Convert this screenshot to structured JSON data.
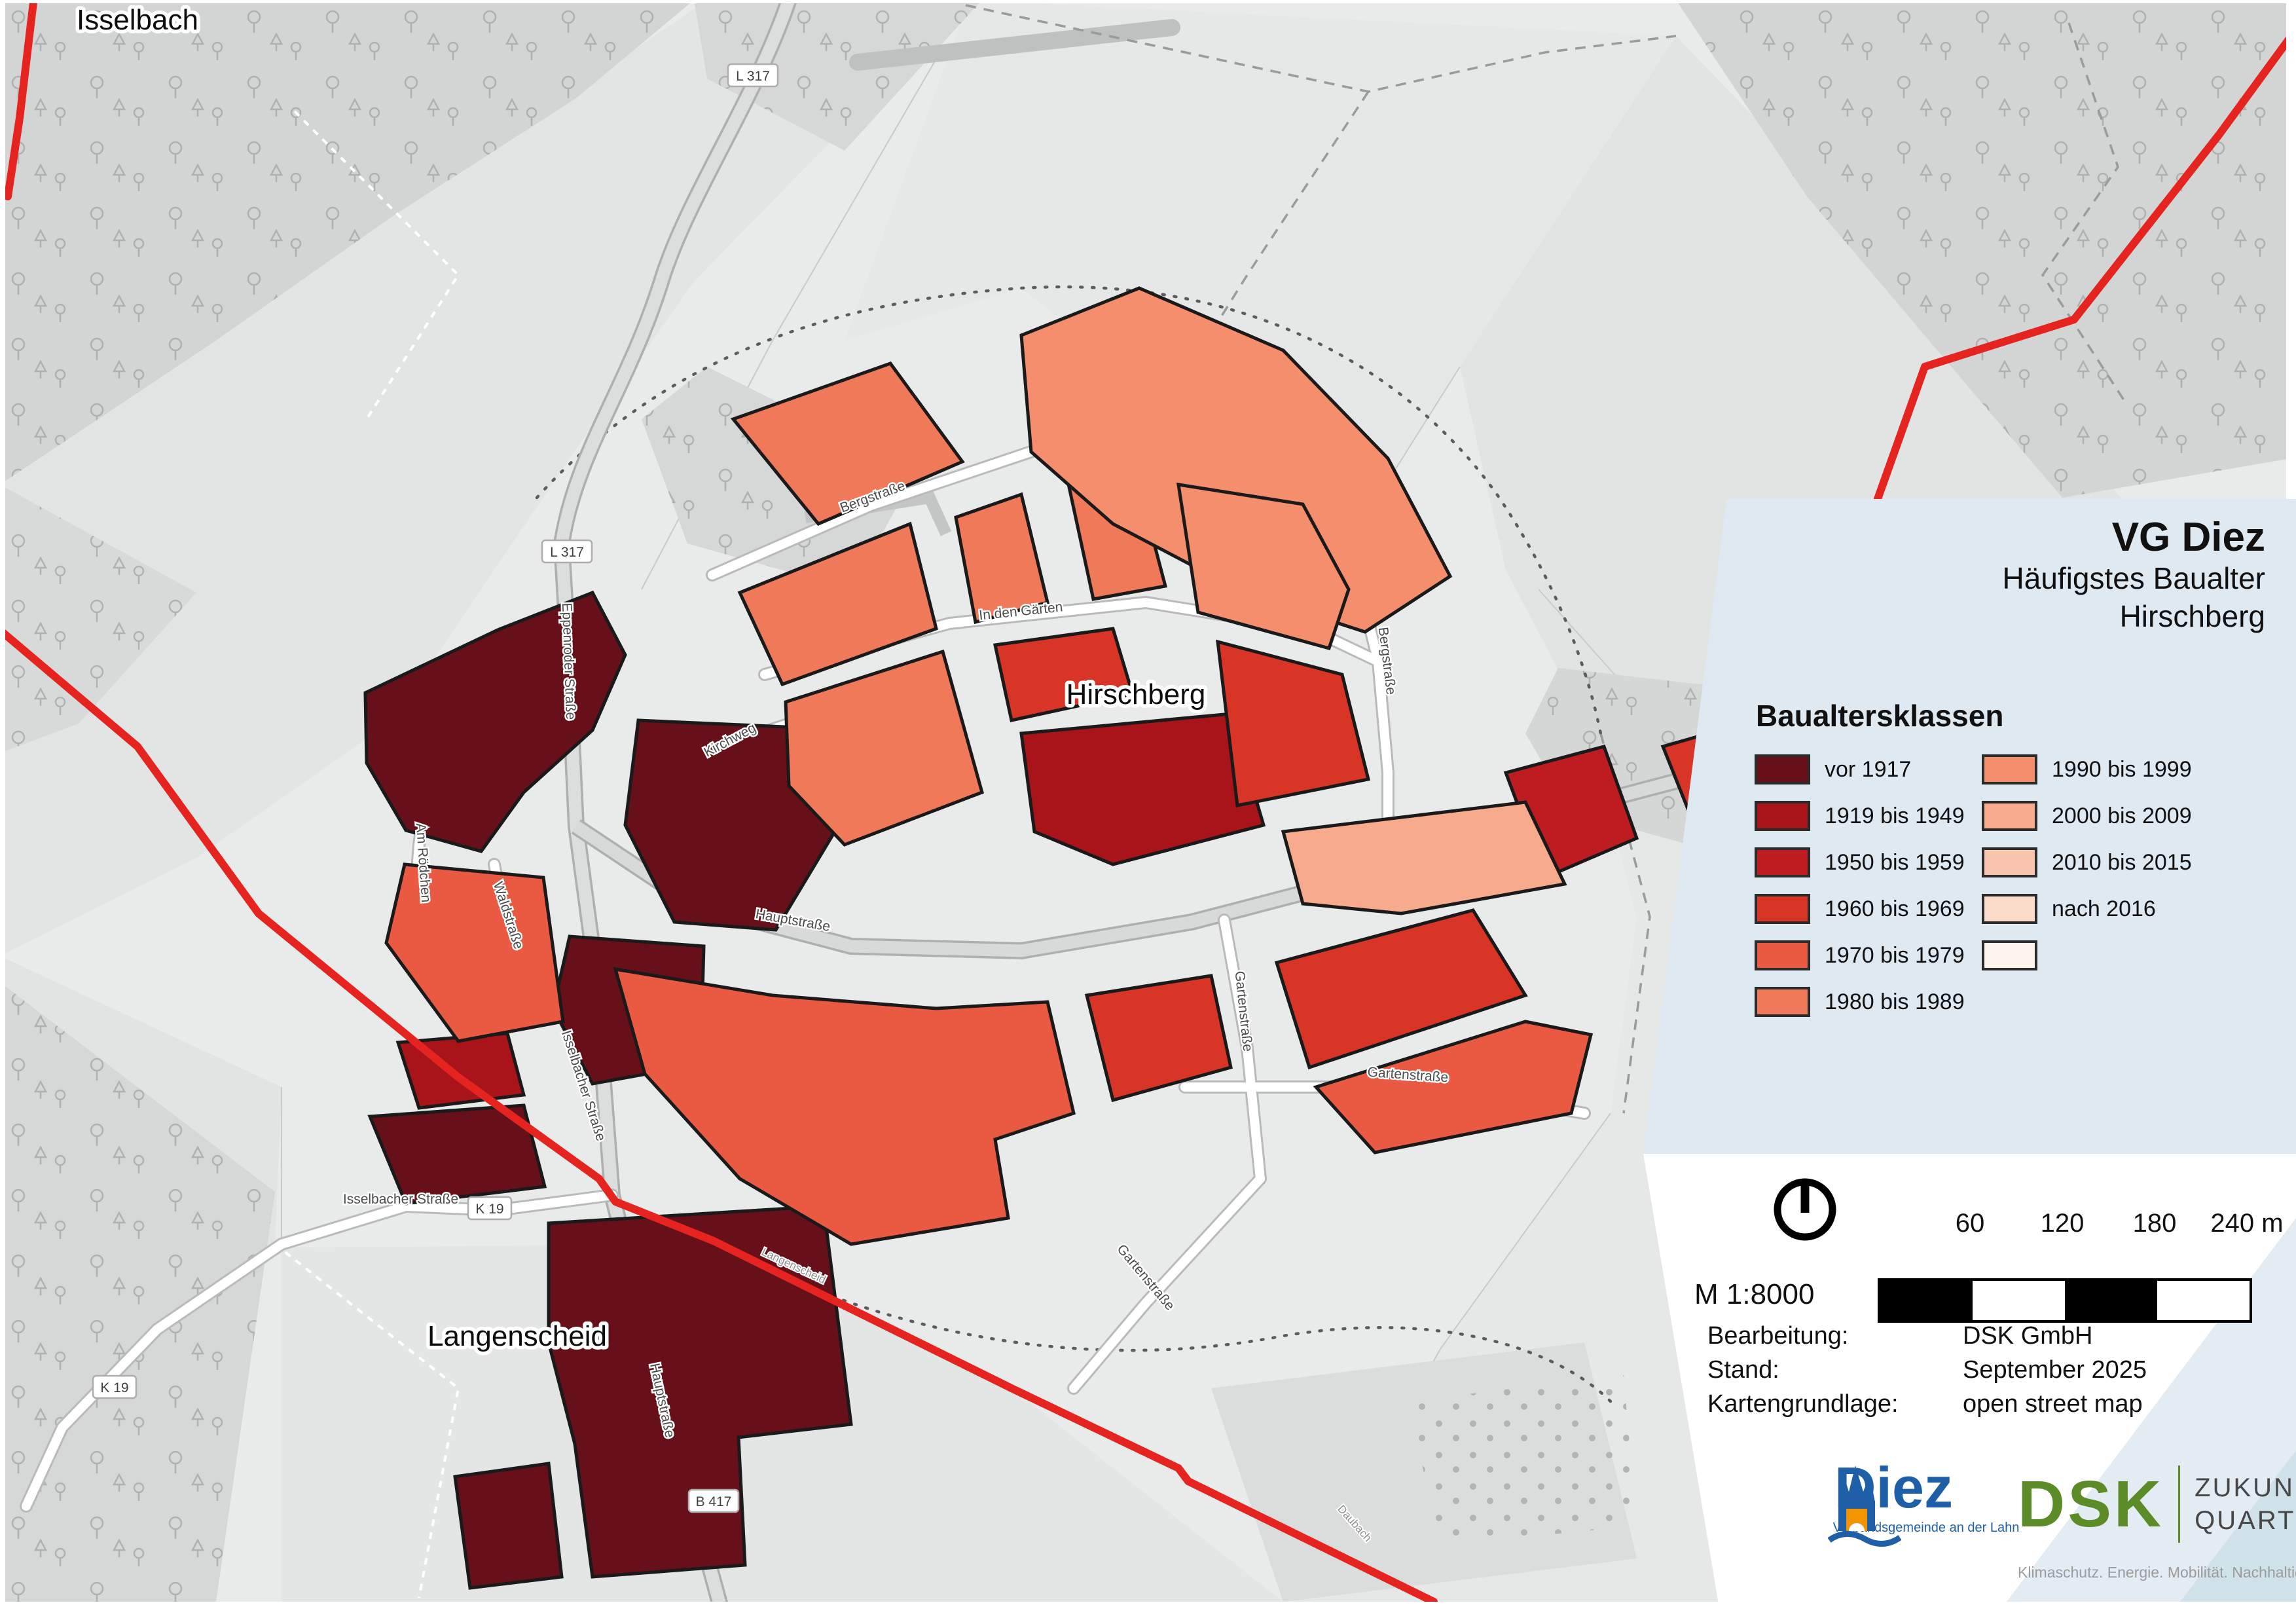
{
  "title": {
    "main": "VG Diez",
    "subtitle": "Häufigstes Baualter",
    "area": "Hirschberg"
  },
  "legend": {
    "heading": "Baualtersklassen",
    "panel_color": "#dfe9f1",
    "items": [
      {
        "label": "vor 1917",
        "color": "#67101a"
      },
      {
        "label": "1919 bis 1949",
        "color": "#a81419"
      },
      {
        "label": "1950 bis 1959",
        "color": "#bf1c21"
      },
      {
        "label": "1960 bis 1969",
        "color": "#d83527"
      },
      {
        "label": "1970 bis 1979",
        "color": "#ea5942"
      },
      {
        "label": "1980 bis 1989",
        "color": "#f0795a"
      },
      {
        "label": "1990 bis 1999",
        "color": "#f48e6c"
      },
      {
        "label": "2000 bis 2009",
        "color": "#f7aa8c"
      },
      {
        "label": "2010 bis 2015",
        "color": "#f9c4ad"
      },
      {
        "label": "nach 2016",
        "color": "#fbdcca"
      },
      {
        "label": "",
        "color": "#fdf4ee"
      }
    ]
  },
  "scale": {
    "ratio_label": "M 1:8000",
    "ticks": [
      "60",
      "120",
      "180",
      "240 m"
    ]
  },
  "attribution": {
    "rows": [
      {
        "label": "Bearbeitung:",
        "value": "DSK GmbH"
      },
      {
        "label": "Stand:",
        "value": "September 2025"
      },
      {
        "label": "Kartengrundlage:",
        "value": "open street map"
      }
    ]
  },
  "logos": {
    "diez": {
      "name": "Diez",
      "subtext": "Verbandsgemeinde an der Lahn",
      "blue": "#1f5fa8",
      "orange": "#f29400"
    },
    "dsk": {
      "name": "DSK",
      "claim_line1": "ZUKUNFT",
      "claim_line2": "QUARTIER",
      "subtext": "Klimaschutz. Energie. Mobilität. Nachhaltigkeit.",
      "green": "#5b8c28"
    }
  },
  "map": {
    "boundary_color": "#e5231f",
    "place_labels": [
      {
        "text": "Isselbach"
      },
      {
        "text": "Hirschberg"
      },
      {
        "text": "Langenscheid"
      }
    ],
    "street_labels": [
      {
        "text": "Bergstraße"
      },
      {
        "text": "Bergstraße"
      },
      {
        "text": "In den Gärten"
      },
      {
        "text": "Kirchweg"
      },
      {
        "text": "Eppenroder Straße"
      },
      {
        "text": "Waldstraße"
      },
      {
        "text": "Am Rödchen"
      },
      {
        "text": "Hauptstraße"
      },
      {
        "text": "Hauptstraße"
      },
      {
        "text": "Hauptstraße"
      },
      {
        "text": "Gartenstraße"
      },
      {
        "text": "Gartenstraße"
      },
      {
        "text": "Gartenstraße"
      },
      {
        "text": "Isselbacher Straße"
      },
      {
        "text": "Isselbacher Straße"
      },
      {
        "text": "Langenscheid"
      },
      {
        "text": "Daubach"
      }
    ],
    "badges": [
      {
        "text": "L 317"
      },
      {
        "text": "L 317"
      },
      {
        "text": "B 417"
      },
      {
        "text": "B 417"
      },
      {
        "text": "K 19"
      },
      {
        "text": "K 19"
      }
    ]
  }
}
